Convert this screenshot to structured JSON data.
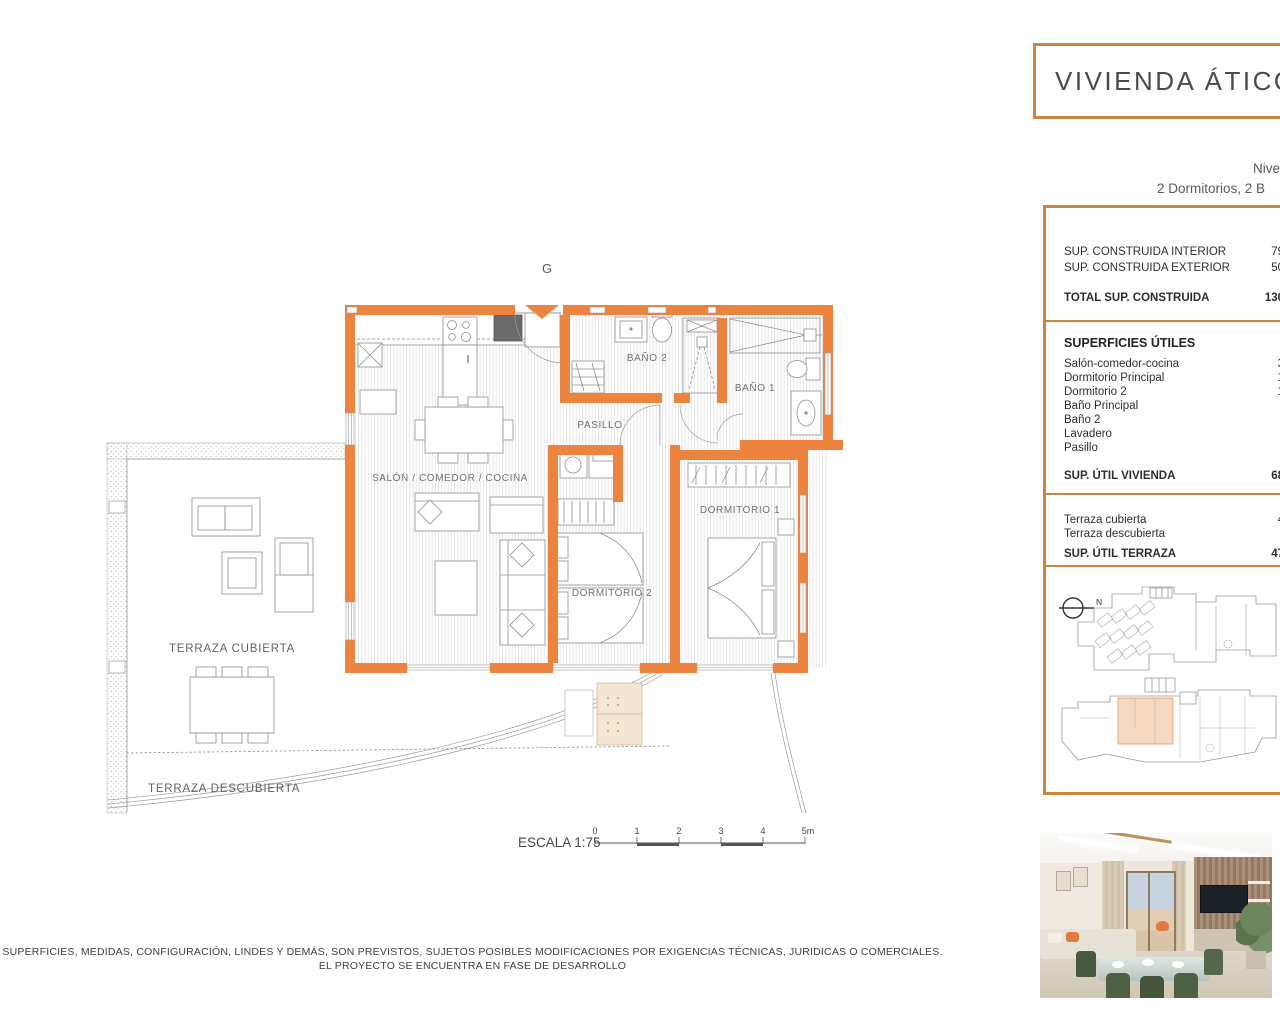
{
  "title": {
    "main": "VIVIENDA ÁTICO G",
    "level_line": "Nive",
    "rooms_line": "2 Dormitorios, 2 B"
  },
  "specs": {
    "built_rows": [
      {
        "label": "SUP. CONSTRUIDA INTERIOR",
        "value": "79,92"
      },
      {
        "label": "SUP. CONSTRUIDA EXTERIOR",
        "value": "50,79"
      }
    ],
    "built_total": {
      "label": "TOTAL SUP. CONSTRUIDA",
      "value": "130,71"
    },
    "useful_heading": "SUPERFICIES ÚTILES",
    "useful_rows": [
      {
        "label": "Salón-comedor-cocina",
        "value": "33,9"
      },
      {
        "label": "Dormitorio Principal",
        "value": "12,7"
      },
      {
        "label": "Dormitorio 2",
        "value": "10,1"
      },
      {
        "label": "Baño Principal",
        "value": "4,6"
      },
      {
        "label": "Baño 2",
        "value": "3,8"
      },
      {
        "label": "Lavadero",
        "value": "1,2"
      },
      {
        "label": "Pasillo",
        "value": "2,1"
      }
    ],
    "useful_total": {
      "label": "SUP. ÚTIL VIVIENDA",
      "value": "68,58"
    },
    "terrace_rows": [
      {
        "label": "Terraza cubierta",
        "value": "45,1"
      },
      {
        "label": "Terraza descubierta",
        "value": "2,3"
      }
    ],
    "terrace_total": {
      "label": "SUP. ÚTIL TERRAZA",
      "value": "47,44"
    },
    "north_label": "N"
  },
  "plan": {
    "block_label": "G",
    "rooms": {
      "salon": "SALÓN / COMEDOR / COCINA",
      "pasillo": "PASILLO",
      "bano2": "BAÑO 2",
      "bano1": "BAÑO 1",
      "dormitorio1": "DORMITORIO 1",
      "dormitorio2": "DORMITORIO 2",
      "terraza_cubierta": "TERRAZA CUBIERTA",
      "terraza_descubierta": "TERRAZA DESCUBIERTA"
    },
    "scale": {
      "label": "ESCALA 1:75",
      "ticks": [
        "0",
        "1",
        "2",
        "3",
        "4",
        "5m"
      ]
    }
  },
  "disclaimer": {
    "line1": "SUPERFICIES, MEDIDAS, CONFIGURACIÓN, LINDES Y DEMÁS, SON PREVISTOS, SUJETOS POSIBLES MODIFICACIONES POR EXIGENCIAS TÉCNICAS, JURIDICAS O COMERCIALES.",
    "line2": "EL PROYECTO SE ENCUENTRA EN FASE DE DESARROLLO"
  },
  "colors": {
    "wall_orange": "#EC8440",
    "panel_border": "#CD8443",
    "unit_highlight": "#F7D9C2",
    "label_gray": "#6E7278",
    "text_dark": "#3F3F3F"
  }
}
